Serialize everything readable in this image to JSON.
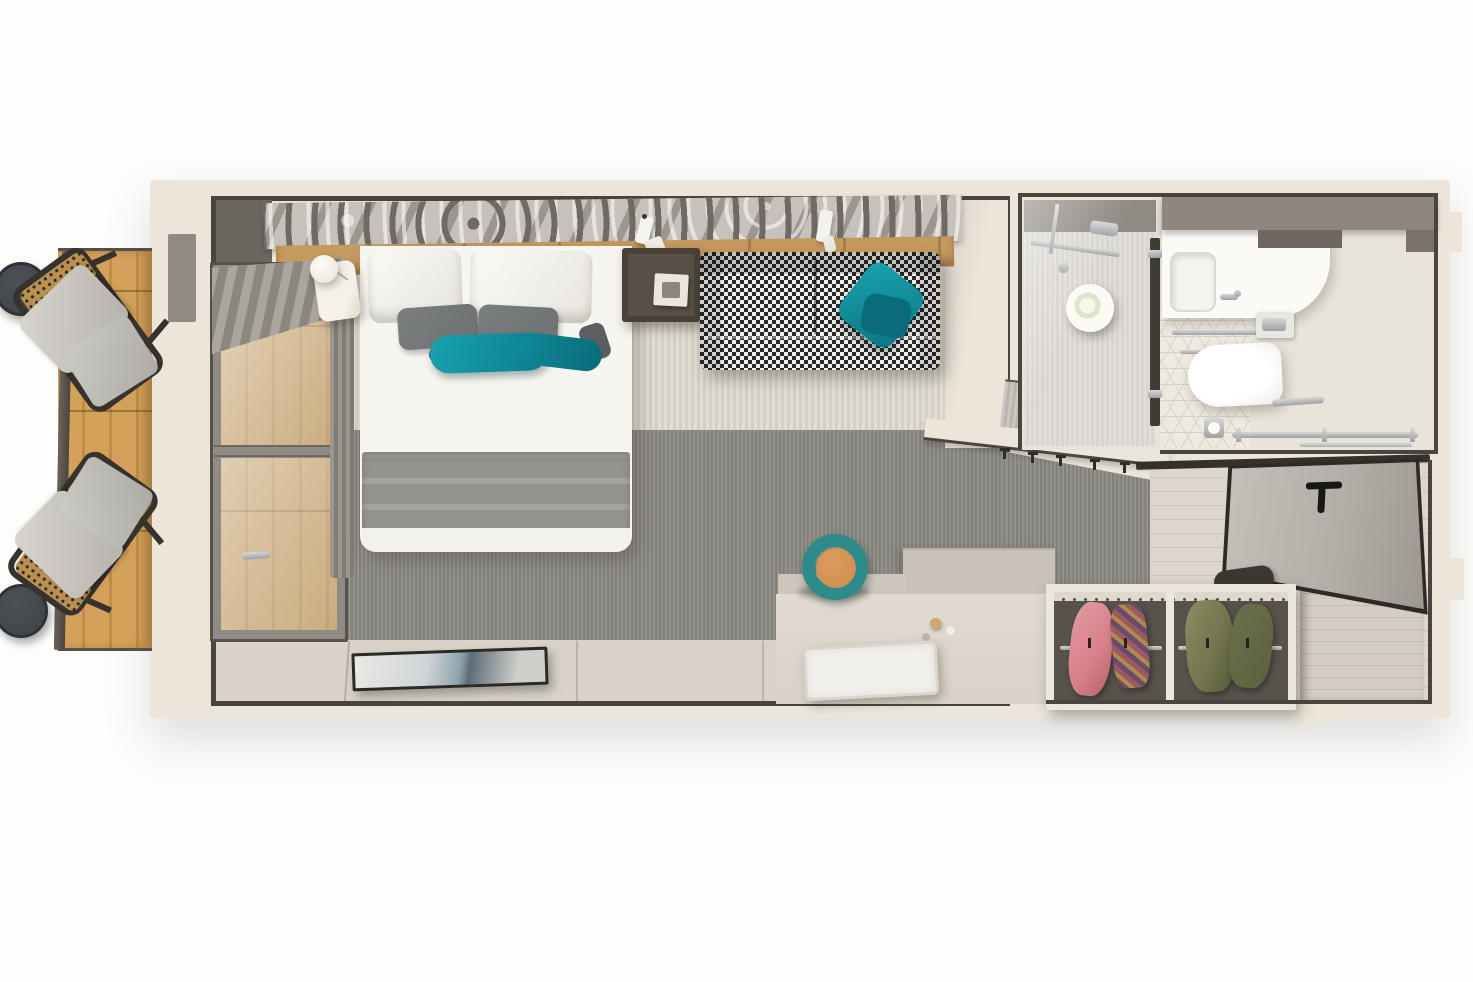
{
  "scene": {
    "type": "top-down 3d floor plan render",
    "subject": "cruise-ship balcony stateroom",
    "has_text": false
  },
  "palette": {
    "wall-cream": "#ebe5da",
    "wall-line": "#49443e",
    "carpet-dark": "#908e88",
    "carpet-dark2": "#827f78",
    "rug-light": "#e2ddd4",
    "rug-light2": "#d5cfc5",
    "floor-beige": "#dcd6cc",
    "console": "#d9d3c9",
    "wood": "#d4a15a",
    "wood-dark": "#bf8d47",
    "art-light": "#c6c2bb",
    "art-dark": "#6f6b64",
    "headboard-tan": "#c59a5f",
    "bed-white": "#f7f5f0",
    "pillow-gray": "#6e7172",
    "teal": "#11919f",
    "teal-dark": "#0b6f7d",
    "blanket-gray": "#959390",
    "sofa-dark": "#2b2a28",
    "sofa-light": "#efeeea",
    "nightstand-dark": "#48413a",
    "chair-frame": "#38322c",
    "cushion-gray": "#cccac4",
    "table-dark": "#42474c",
    "shower-floor": "#d8d4ce",
    "shelf-gray": "#8e877d",
    "toilet-white": "#fbfaf7",
    "door-gray": "#b1ada7",
    "door-edge": "#2e2b27",
    "wardrobe-int": "#57524b",
    "clothes-pink": "#d8808a",
    "clothes-green": "#73764e",
    "clothes-green2": "#5c6040",
    "desk": "#d8d2c8",
    "desk-ledge": "#c8c2b8",
    "chair-teal": "#2f8a8a",
    "chair-orange": "#cd8a4e",
    "tile-line": "#d8d2c6",
    "marble-white": "#f4f1ea"
  },
  "regions": {
    "balcony": {
      "items": [
        "wood-deck",
        "railing",
        "side-table",
        "side-table",
        "deck-chair",
        "deck-chair"
      ]
    },
    "bedroom": {
      "items": [
        "sliding-glass-door",
        "roman-blind",
        "curtain",
        "accent-art-wall",
        "headboard",
        "double-bed",
        "white-pillows",
        "gray-pillows",
        "teal-pillows",
        "gray-blanket",
        "marble-nightstand",
        "globe-lamp",
        "wall-sconce",
        "dark-nightstand",
        "houndstooth-sofa",
        "teal-throw-pillow",
        "light-striped-rug",
        "dark-carpet",
        "wall-console",
        "flat-tv",
        "desk",
        "desk-chair",
        "serving-tray",
        "coat-hooks"
      ]
    },
    "bathroom": {
      "items": [
        "shower-enclosure",
        "shower-fixtures",
        "towel-roll",
        "glass-door",
        "vanity-counter",
        "wash-basin",
        "faucet",
        "towel-bar",
        "overhead-shelf",
        "toilet",
        "flush-panel",
        "toilet-paper-holder",
        "grab-rail",
        "hex-tile-floor"
      ]
    },
    "entry": {
      "items": [
        "entry-door",
        "door-handle",
        "door-frame",
        "wardrobe",
        "hanging-rail",
        "pink-clothes",
        "patterned-clothes",
        "green-clothes",
        "luggage-bench",
        "shoes",
        "vestibule-floor"
      ]
    }
  }
}
